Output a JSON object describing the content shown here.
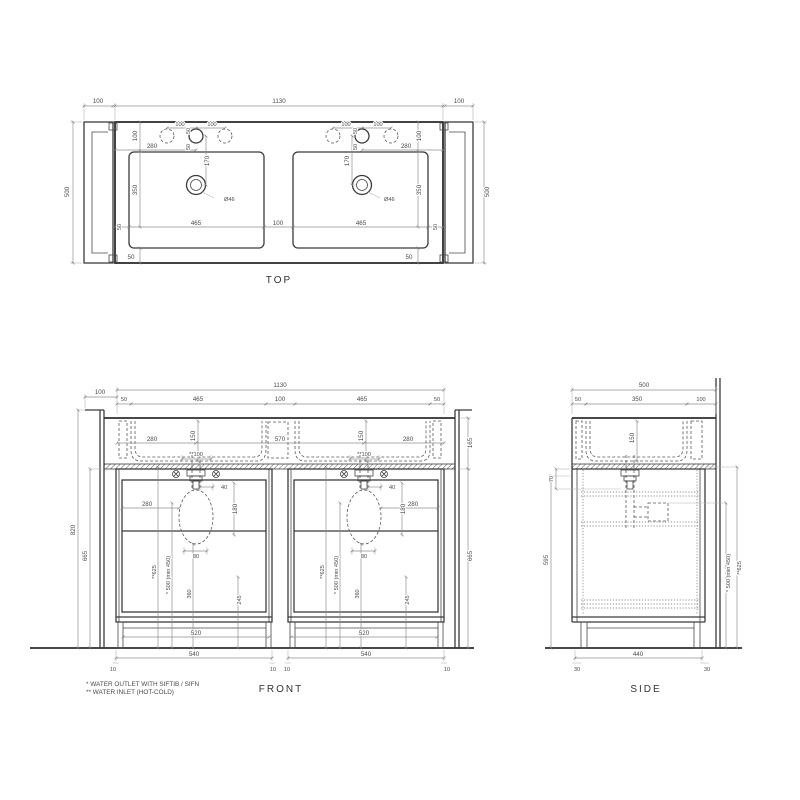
{
  "drawing": {
    "background": "#ffffff",
    "line_color": "#3b3b3b",
    "dim_color": "#8f8f8f",
    "views": {
      "top": {
        "label": "TOP",
        "dims": {
          "wing": "100",
          "overall": "1130",
          "height": "500",
          "hole_spacing": "100",
          "hole_offset": "50",
          "setback": "280",
          "edge_to_basin": "100",
          "faucet_to_drain": "170",
          "drain_dia": "Ø46",
          "basin_length": "350",
          "basin_width": "465",
          "basin_gap": "100",
          "side_inset": "50",
          "bottom_inset": "50"
        }
      },
      "front": {
        "label": "FRONT",
        "dims": {
          "overall": "1130",
          "wing": "100",
          "edge_inset": "50",
          "basin_width": "465",
          "basin_gap": "100",
          "basin_depth": "150",
          "trap_from_edge": "280",
          "trap_spacing": "570",
          "inlet_spacing": "**100",
          "counter_height": "165",
          "total_height": "820",
          "offset_40": "40",
          "trap_from_side": "280",
          "trap_height": "180",
          "trap_width": "80",
          "inlet_height": "**625",
          "outlet_height": "* 500 (min 450)",
          "outlet_center": "360",
          "trap_center": "245",
          "cabinet_height": "665",
          "plinth_width": "520",
          "cabinet_width": "540",
          "foot_inset": "10"
        },
        "notes": [
          "*  WATER OUTLET WITH SIFTIB / SIFN",
          "** WATER INLET (HOT-COLD)"
        ]
      },
      "side": {
        "label": "SIDE",
        "dims": {
          "depth": "500",
          "front_inset": "50",
          "basin_plan_depth": "350",
          "back_inset": "100",
          "basin_depth": "150",
          "flange_height": "70",
          "cabinet_height": "595",
          "outlet_height": "* 500 (min 450)",
          "inlet_height": "**625",
          "cabinet_depth": "440",
          "foot_inset": "30"
        }
      }
    }
  }
}
